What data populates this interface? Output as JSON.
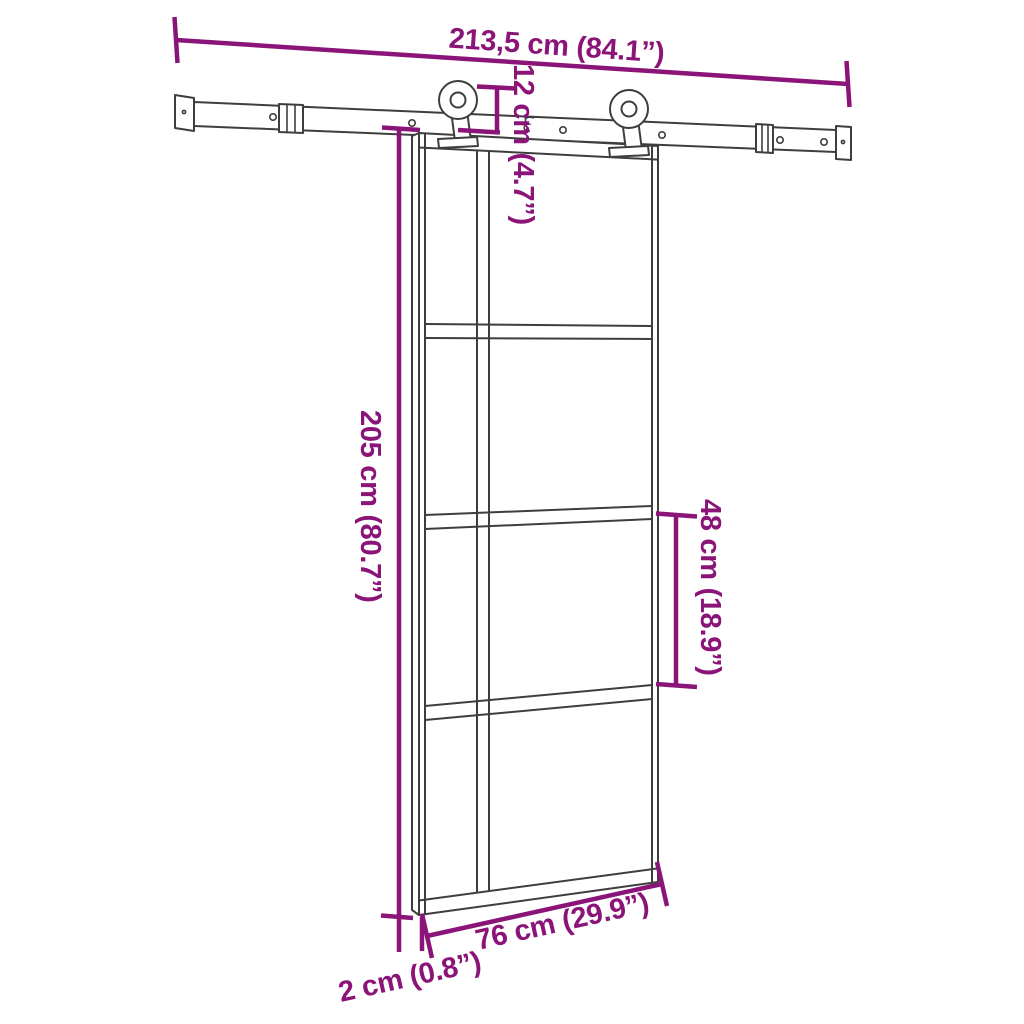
{
  "diagram": {
    "type": "product-dimension-diagram",
    "subject": "sliding glass door with top-mounted barn-door rail and two rollers",
    "colors": {
      "dimension_accent": "#8a1478",
      "line_art": "#3e3e3e",
      "background": "#ffffff"
    },
    "dimensions": {
      "rail_width": "213,5 cm (84.1”)",
      "hanger_drop": "12 cm (4.7”)",
      "door_height": "205 cm (80.7”)",
      "panel_height": "48 cm (18.9”)",
      "door_width": "76 cm (29.9”)",
      "door_thickness": "2 cm (0.8”)"
    }
  }
}
